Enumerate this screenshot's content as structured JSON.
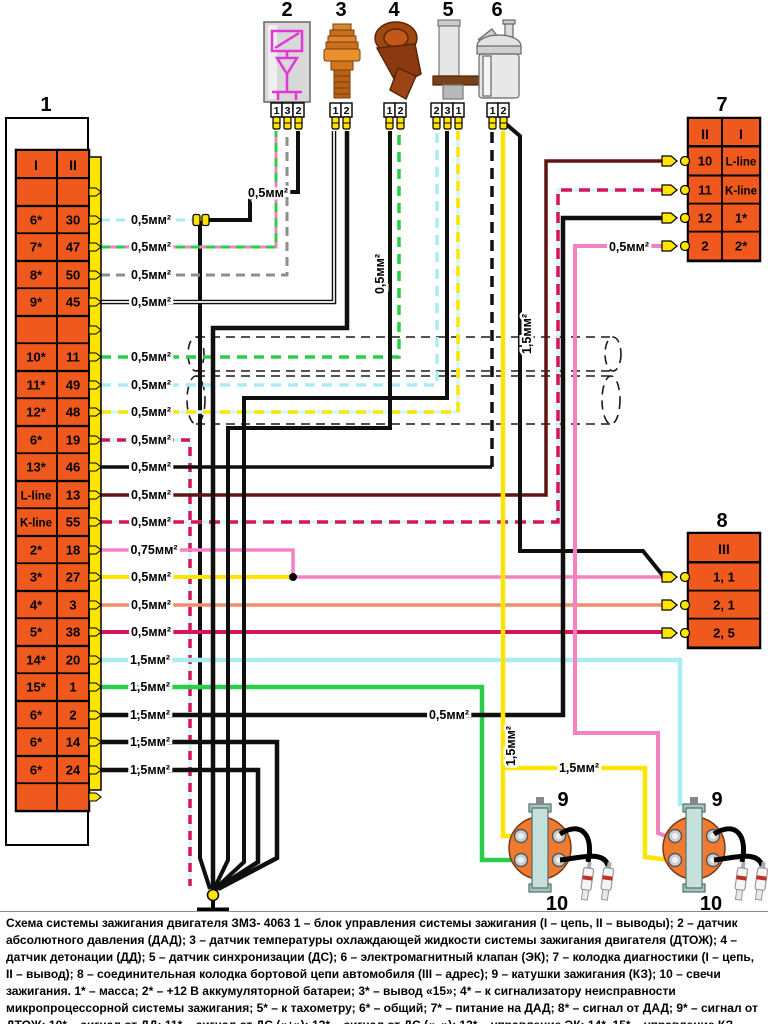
{
  "caption": "Схема системы зажигания двигателя ЗМЗ- 4063 1 – блок управления системы зажигания (I – цепь, II – выводы); 2 – датчик абсолютного давления (ДАД); 3 – датчик температуры охлаждающей жидкости системы зажигания двигателя (ДТОЖ); 4 – датчик детонации (ДД); 5 – датчик синхронизации (ДС); 6 – электромагнитный клапан (ЭК); 7 – колодка диагностики (I – цепь, II – вывод); 8 – соединительная колодка бортовой цепи автомобиля (III – адрес); 9 – катушки зажигания (КЗ); 10 – свечи зажигания. 1* – масса; 2* – +12 В аккумуляторной батареи; 3* – вывод «15»; 4* – к сигнализатору неисправности микропроцессорной системы зажигания; 5* – к тахометру; 6* – общий; 7* – питание на ДАД; 8* – сигнал от ДАД; 9* – сигнал от ДТОЖ; 10* – сигнал от ДД; 11* – сигнал от ДС («+»); 12* – сигнал от ДС («–»); 13* – управление ЭК; 14*, 15* – управление КЗ.",
  "colors": {
    "orange": "#F0591E",
    "yellow": "#FFE400",
    "cyan": "#A9EDF3",
    "cyan_pale": "#D6F7FA",
    "green": "#2BCE4A",
    "pink": "#F580C2",
    "crimson": "#D5155A",
    "salmon": "#F28B6B",
    "brown": "#5E1410",
    "gray": "#8E8E8A",
    "black": "#0F0F0F",
    "magenta": "#E236D6",
    "coil_orange": "#EF7B30",
    "coil_bar": "#C6E0DC",
    "silver": "#D8D8D8"
  },
  "block1": {
    "label": "1",
    "col1": "I",
    "col2": "II",
    "rows": [
      {
        "c1": "",
        "c2": "",
        "y": 192
      },
      {
        "c1": "6*",
        "c2": "30",
        "y": 220
      },
      {
        "c1": "7*",
        "c2": "47",
        "y": 247
      },
      {
        "c1": "8*",
        "c2": "50",
        "y": 275
      },
      {
        "c1": "9*",
        "c2": "45",
        "y": 302
      },
      {
        "c1": "",
        "c2": "",
        "y": 330
      },
      {
        "c1": "10*",
        "c2": "11",
        "y": 357
      },
      {
        "c1": "11*",
        "c2": "49",
        "y": 385
      },
      {
        "c1": "12*",
        "c2": "48",
        "y": 412
      },
      {
        "c1": "6*",
        "c2": "19",
        "y": 440
      },
      {
        "c1": "13*",
        "c2": "46",
        "y": 467
      },
      {
        "c1": "L-line",
        "c2": "13",
        "y": 495
      },
      {
        "c1": "K-line",
        "c2": "55",
        "y": 522
      },
      {
        "c1": "2*",
        "c2": "18",
        "y": 550
      },
      {
        "c1": "3*",
        "c2": "27",
        "y": 577
      },
      {
        "c1": "4*",
        "c2": "3",
        "y": 605
      },
      {
        "c1": "5*",
        "c2": "38",
        "y": 632
      },
      {
        "c1": "14*",
        "c2": "20",
        "y": 660
      },
      {
        "c1": "15*",
        "c2": "1",
        "y": 687
      },
      {
        "c1": "6*",
        "c2": "2",
        "y": 715
      },
      {
        "c1": "6*",
        "c2": "14",
        "y": 742
      },
      {
        "c1": "6*",
        "c2": "24",
        "y": 770
      },
      {
        "c1": "",
        "c2": "",
        "y": 797
      }
    ]
  },
  "block7": {
    "label": "7",
    "col1": "II",
    "col2": "I",
    "rows": [
      {
        "c1": "10",
        "c2": "L-line",
        "y": 161
      },
      {
        "c1": "11",
        "c2": "K-line",
        "y": 190
      },
      {
        "c1": "12",
        "c2": "1*",
        "y": 218
      },
      {
        "c1": "2",
        "c2": "2*",
        "y": 246
      }
    ]
  },
  "block8": {
    "label": "8",
    "header": "III",
    "rows": [
      {
        "c": "1, 1",
        "y": 577
      },
      {
        "c": "2, 1",
        "y": 605
      },
      {
        "c": "2, 5",
        "y": 633
      }
    ]
  },
  "sensors": [
    {
      "label": "2",
      "labelx": 287,
      "x": 271,
      "pins": [
        "1",
        "3",
        "2"
      ]
    },
    {
      "label": "3",
      "labelx": 341,
      "x": 330,
      "pins": [
        "1",
        "2"
      ]
    },
    {
      "label": "4",
      "labelx": 394,
      "x": 384,
      "pins": [
        "1",
        "2"
      ]
    },
    {
      "label": "5",
      "labelx": 448,
      "x": 431,
      "pins": [
        "2",
        "3",
        "1"
      ]
    },
    {
      "label": "6",
      "labelx": 497,
      "x": 487,
      "pins": [
        "1",
        "2"
      ]
    }
  ],
  "coils": [
    {
      "cx": 540,
      "label": "9",
      "plug_label": "10"
    },
    {
      "cx": 694,
      "label": "9",
      "plug_label": "10"
    }
  ],
  "wires": [
    {
      "n": "wire-6-30",
      "pts": [
        [
          101,
          220
        ],
        [
          202,
          220
        ]
      ],
      "c": "cyan",
      "w": 3,
      "d": "9 6"
    },
    {
      "n": "wire-s2-pin2-ground",
      "pts": [
        [
          202,
          220
        ],
        [
          250,
          220
        ],
        [
          250,
          192
        ],
        [
          298,
          192
        ],
        [
          298,
          131
        ]
      ],
      "c": "black",
      "w": 4
    },
    {
      "n": "wire-joint-to-ground",
      "pts": [
        [
          200,
          221
        ],
        [
          200,
          858
        ],
        [
          210,
          889
        ]
      ],
      "c": "black",
      "w": 4
    },
    {
      "n": "wire-7-47",
      "pts": [
        [
          101,
          247
        ],
        [
          276,
          247
        ],
        [
          276,
          131
        ]
      ],
      "c": "green",
      "w": 3,
      "d": "9 6",
      "base": "pink"
    },
    {
      "n": "wire-8-50",
      "pts": [
        [
          101,
          275
        ],
        [
          287,
          275
        ],
        [
          287,
          131
        ]
      ],
      "c": "gray",
      "w": 3,
      "d": "9 6"
    },
    {
      "n": "wire-9-45",
      "pts": [
        [
          101,
          302
        ],
        [
          334,
          302
        ],
        [
          334,
          131
        ]
      ],
      "c": "black",
      "w": 4.5,
      "double": true
    },
    {
      "n": "wire-10-11",
      "pts": [
        [
          101,
          357
        ],
        [
          399,
          357
        ],
        [
          399,
          131
        ]
      ],
      "c": "green",
      "w": 3.5,
      "d": "10 7"
    },
    {
      "n": "wire-11-49",
      "pts": [
        [
          101,
          385
        ],
        [
          437,
          385
        ],
        [
          437,
          131
        ]
      ],
      "c": "cyan",
      "w": 3.5,
      "d": "10 7"
    },
    {
      "n": "wire-12-48",
      "pts": [
        [
          101,
          412
        ],
        [
          458,
          412
        ],
        [
          458,
          131
        ]
      ],
      "c": "yellow",
      "w": 3.5,
      "d": "10 7",
      "base": "cyan_pale"
    },
    {
      "n": "wire-6-19",
      "pts": [
        [
          101,
          440
        ],
        [
          190,
          440
        ],
        [
          190,
          886
        ]
      ],
      "c": "crimson",
      "w": 3.5,
      "d": "9 7",
      "base": "cyan_pale"
    },
    {
      "n": "wire-13-46",
      "pts": [
        [
          101,
          467
        ],
        [
          492,
          467
        ]
      ],
      "c": "black",
      "w": 3.5
    },
    {
      "n": "wire-ek-riser",
      "pts": [
        [
          492,
          467
        ],
        [
          492,
          131
        ]
      ],
      "c": "black",
      "w": 3.5,
      "d": "11 7"
    },
    {
      "n": "wire-l-line",
      "pts": [
        [
          101,
          495
        ],
        [
          546,
          495
        ],
        [
          546,
          161
        ],
        [
          664,
          161
        ]
      ],
      "c": "brown",
      "w": 3.5
    },
    {
      "n": "wire-k-line",
      "pts": [
        [
          101,
          522
        ],
        [
          558,
          522
        ],
        [
          558,
          190
        ],
        [
          664,
          190
        ]
      ],
      "c": "crimson",
      "w": 3.5,
      "d": "11 7",
      "base": "cyan_pale"
    },
    {
      "n": "wire-2-18",
      "pts": [
        [
          101,
          550
        ],
        [
          293,
          550
        ],
        [
          293,
          577
        ],
        [
          664,
          577
        ]
      ],
      "c": "pink",
      "w": 3.5
    },
    {
      "n": "wire-3-27",
      "pts": [
        [
          101,
          577
        ],
        [
          293,
          577
        ]
      ],
      "c": "yellow",
      "w": 4
    },
    {
      "n": "wire-4-3",
      "pts": [
        [
          101,
          605
        ],
        [
          664,
          605
        ]
      ],
      "c": "salmon",
      "w": 3.5
    },
    {
      "n": "wire-5-38",
      "pts": [
        [
          101,
          632
        ],
        [
          664,
          632
        ]
      ],
      "c": "crimson",
      "w": 4
    },
    {
      "n": "wire-14-20",
      "pts": [
        [
          101,
          660
        ],
        [
          680,
          660
        ],
        [
          680,
          806
        ]
      ],
      "c": "cyan",
      "w": 4.5
    },
    {
      "n": "wire-15-1",
      "pts": [
        [
          101,
          687
        ],
        [
          482,
          687
        ],
        [
          482,
          860
        ],
        [
          516,
          860
        ]
      ],
      "c": "green",
      "w": 4.5
    },
    {
      "n": "wire-6-2",
      "pts": [
        [
          101,
          715
        ],
        [
          563,
          715
        ],
        [
          563,
          218
        ],
        [
          664,
          218
        ]
      ],
      "c": "black",
      "w": 4.5
    },
    {
      "n": "wire-6-14",
      "pts": [
        [
          101,
          742
        ],
        [
          277,
          742
        ],
        [
          277,
          858
        ],
        [
          218,
          889
        ]
      ],
      "c": "black",
      "w": 4.5
    },
    {
      "n": "wire-6-24",
      "pts": [
        [
          101,
          770
        ],
        [
          258,
          770
        ],
        [
          258,
          862
        ],
        [
          216,
          889
        ]
      ],
      "c": "black",
      "w": 4.5
    },
    {
      "n": "wire-s3-ground",
      "pts": [
        [
          347,
          131
        ],
        [
          347,
          328
        ],
        [
          213,
          328
        ],
        [
          213,
          889
        ]
      ],
      "c": "black",
      "w": 4.5
    },
    {
      "n": "wire-s4-ground",
      "pts": [
        [
          390,
          131
        ],
        [
          390,
          428
        ],
        [
          228,
          428
        ],
        [
          228,
          860
        ],
        [
          214,
          889
        ]
      ],
      "c": "black",
      "w": 4
    },
    {
      "n": "wire-s5-ground",
      "pts": [
        [
          447,
          131
        ],
        [
          447,
          398
        ],
        [
          244,
          398
        ],
        [
          244,
          862
        ],
        [
          215,
          889
        ]
      ],
      "c": "black",
      "w": 4
    },
    {
      "n": "wire-s6-supply-black",
      "pts": [
        [
          506,
          124
        ],
        [
          520,
          136
        ],
        [
          520,
          551
        ],
        [
          643,
          551
        ],
        [
          664,
          577
        ]
      ],
      "c": "black",
      "w": 4
    },
    {
      "n": "wire-s6-yellow-main",
      "pts": [
        [
          503,
          131
        ],
        [
          503,
          836
        ],
        [
          516,
          836
        ]
      ],
      "c": "yellow",
      "w": 4.5
    },
    {
      "n": "wire-yellow-coil-branch",
      "pts": [
        [
          503,
          768
        ],
        [
          645,
          768
        ],
        [
          645,
          857
        ],
        [
          670,
          860
        ]
      ],
      "c": "yellow",
      "w": 4.5
    },
    {
      "n": "wire-block7-pin2-pink",
      "pts": [
        [
          664,
          246
        ],
        [
          575,
          246
        ],
        [
          575,
          733
        ],
        [
          658,
          733
        ],
        [
          658,
          833
        ],
        [
          668,
          837
        ]
      ],
      "c": "pink",
      "w": 4
    }
  ],
  "wire_labels": [
    {
      "t": "0,5мм²",
      "x": 151,
      "y": 224
    },
    {
      "t": "0,5мм²",
      "x": 151,
      "y": 251
    },
    {
      "t": "0,5мм²",
      "x": 151,
      "y": 279
    },
    {
      "t": "0,5мм²",
      "x": 151,
      "y": 306
    },
    {
      "t": "0,5мм²",
      "x": 151,
      "y": 361
    },
    {
      "t": "0,5мм²",
      "x": 151,
      "y": 389
    },
    {
      "t": "0,5мм²",
      "x": 151,
      "y": 416
    },
    {
      "t": "0,5мм²",
      "x": 151,
      "y": 444
    },
    {
      "t": "0,5мм²",
      "x": 151,
      "y": 471
    },
    {
      "t": "0,5мм²",
      "x": 151,
      "y": 499
    },
    {
      "t": "0,5мм²",
      "x": 151,
      "y": 526
    },
    {
      "t": "0,75мм²",
      "x": 154,
      "y": 554
    },
    {
      "t": "0,5мм²",
      "x": 151,
      "y": 581
    },
    {
      "t": "0,5мм²",
      "x": 151,
      "y": 609
    },
    {
      "t": "0,5мм²",
      "x": 151,
      "y": 636
    },
    {
      "t": "1,5мм²",
      "x": 150,
      "y": 664
    },
    {
      "t": "1,5мм²",
      "x": 150,
      "y": 691
    },
    {
      "t": "1,5мм²",
      "x": 150,
      "y": 719
    },
    {
      "t": "1,5мм²",
      "x": 150,
      "y": 746
    },
    {
      "t": "1,5мм²",
      "x": 150,
      "y": 774
    },
    {
      "t": "0,5мм²",
      "x": 268,
      "y": 197
    },
    {
      "t": "0,5мм²",
      "x": 384,
      "y": 274,
      "r": -90
    },
    {
      "t": "1,5мм²",
      "x": 531,
      "y": 334,
      "r": -90
    },
    {
      "t": "1,5мм²",
      "x": 515,
      "y": 746,
      "r": -90
    },
    {
      "t": "0,5мм²",
      "x": 449,
      "y": 719
    },
    {
      "t": "1,5мм²",
      "x": 579,
      "y": 772
    },
    {
      "t": "0,5мм²",
      "x": 629,
      "y": 251
    }
  ],
  "nodes": [
    {
      "type": "dot",
      "x": 293,
      "y": 577
    },
    {
      "type": "joint",
      "x": 196,
      "y": 220
    },
    {
      "type": "joint",
      "x": 205,
      "y": 220
    }
  ]
}
